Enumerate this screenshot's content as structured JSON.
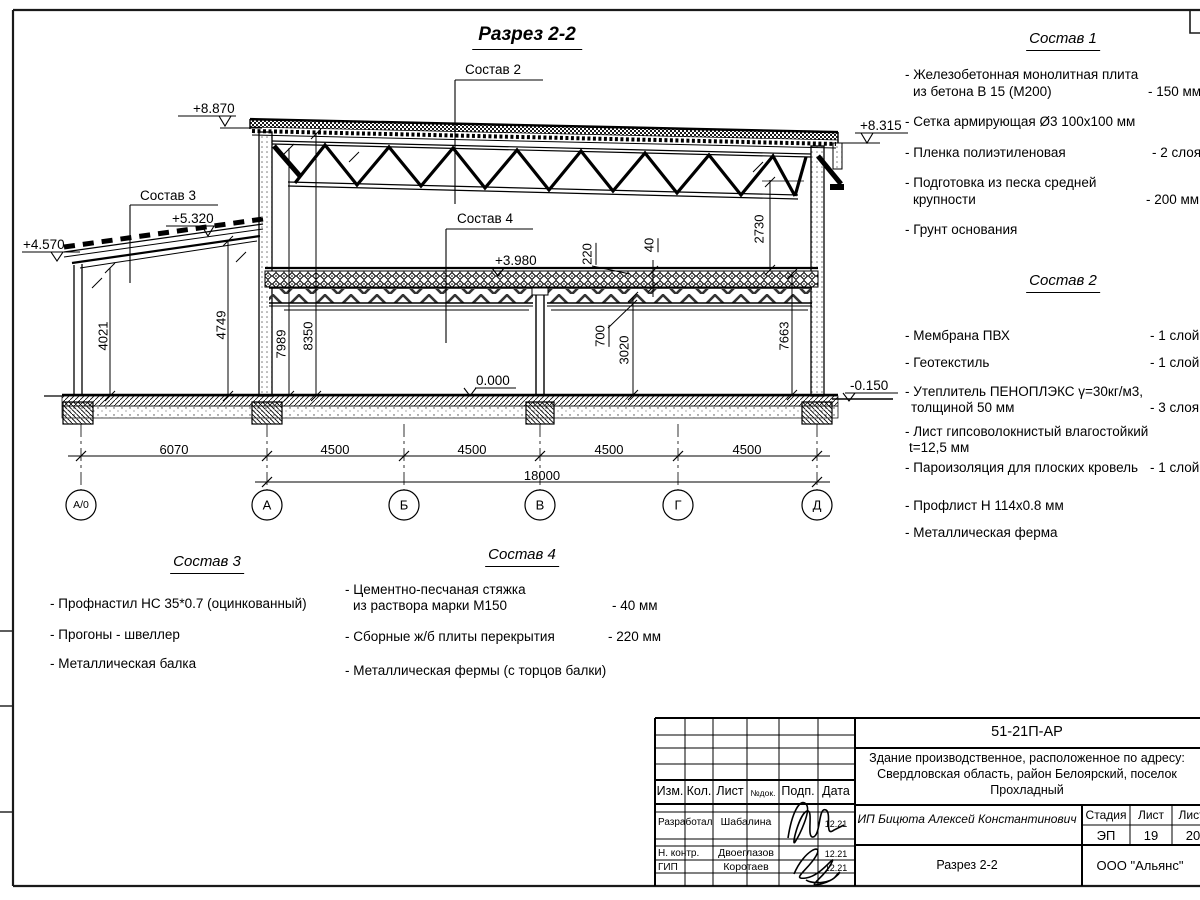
{
  "sheet": {
    "section_title": "Разрез 2-2"
  },
  "levels": {
    "top_main": "+8.870",
    "top_right": "+8.315",
    "leanto_top": "+5.320",
    "leanto_eave": "+4.570",
    "floor2": "+3.980",
    "floor0": "0.000",
    "ground": "-0.150"
  },
  "axes": {
    "a0": "А/0",
    "a": "А",
    "b": "Б",
    "v": "В",
    "g": "Г",
    "d": "Д"
  },
  "dims": {
    "span1": "6070",
    "span2": "4500",
    "span3": "4500",
    "span4": "4500",
    "span5": "4500",
    "total": "18000",
    "h_leanto_left": "4021",
    "h_leanto_right": "4749",
    "h_wall_inner": "7989",
    "h_wall": "8350",
    "h_truss": "2730",
    "h_right": "7663",
    "truss_depth": "700",
    "h_floor": "3020",
    "slab": "220",
    "screed": "40"
  },
  "leaders": {
    "s2": "Состав 2",
    "s3": "Состав 3",
    "s4": "Состав 4"
  },
  "lists": {
    "s1": {
      "title": "Состав 1",
      "items": [
        {
          "t": "- Железобетонная  монолитная плита",
          "t2": "из бетона В 15 (М200)",
          "v": "- 150 мм"
        },
        {
          "t": "- Сетка армирующая Ø3 100х100 мм"
        },
        {
          "t": "- Пленка полиэтиленовая",
          "v": "- 2 слоя"
        },
        {
          "t": "- Подготовка из песка средней",
          "t2": "крупности",
          "v": "- 200 мм"
        },
        {
          "t": "- Грунт основания"
        }
      ]
    },
    "s2": {
      "title": "Состав 2",
      "items": [
        {
          "t": "- Мембрана ПВХ",
          "v": "- 1 слой"
        },
        {
          "t": "- Геотекстиль",
          "v": "- 1 слой"
        },
        {
          "t": "- Утеплитель ПЕНОПЛЭКС γ=30кг/м3,",
          "t2": "толщиной 50 мм",
          "v": "- 3 слоя"
        },
        {
          "t": "- Лист гипсоволокнистый влагостойкий",
          "t2": "t=12,5 мм"
        },
        {
          "t": "- Пароизоляция для плоских кровель",
          "v": "- 1 слой"
        },
        {
          "t": "- Профлист Н 114х0.8 мм"
        },
        {
          "t": "- Металлическая ферма"
        }
      ]
    },
    "s3": {
      "title": "Состав 3",
      "items": [
        {
          "t": "- Профнастил НС 35*0.7 (оцинкованный)"
        },
        {
          "t": "- Прогоны - швеллер"
        },
        {
          "t": "- Металлическая балка"
        }
      ]
    },
    "s4": {
      "title": "Состав 4",
      "items": [
        {
          "t": "- Цементно-песчаная стяжка",
          "t2": "из раствора марки М150",
          "v": "- 40 мм"
        },
        {
          "t": "- Сборные ж/б плиты перекрытия",
          "v": "- 220 мм"
        },
        {
          "t": "- Металлическая фермы (с торцов балки)"
        }
      ]
    }
  },
  "title_block": {
    "doc_number": "51-21П-АР",
    "object_line1": "Здание производственное, расположенное по адресу:",
    "object_line2": "Свердловская область, район Белоярский, поселок",
    "object_line3": "Прохладный",
    "cols": {
      "izm": "Изм.",
      "kol": "Кол.",
      "list": "Лист",
      "ndok": "№док.",
      "podp": "Подп.",
      "data": "Дата"
    },
    "rows": [
      {
        "role": "Разработал",
        "name": "Шабалина",
        "date": "12.21"
      },
      {
        "role": "Н. контр.",
        "name": "Двоеглазов",
        "date": "12.21"
      },
      {
        "role": "ГИП",
        "name": "Коротаев",
        "date": "12.21"
      }
    ],
    "customer": "ИП Бицюта Алексей Константинович",
    "stage_label": "Стадия",
    "sheet_label": "Лист",
    "sheets_label": "Листов",
    "stage": "ЭП",
    "sheet": "19",
    "sheets": "20",
    "drawing_name": "Разрез 2-2",
    "company": "ООО \"Альянс\""
  }
}
